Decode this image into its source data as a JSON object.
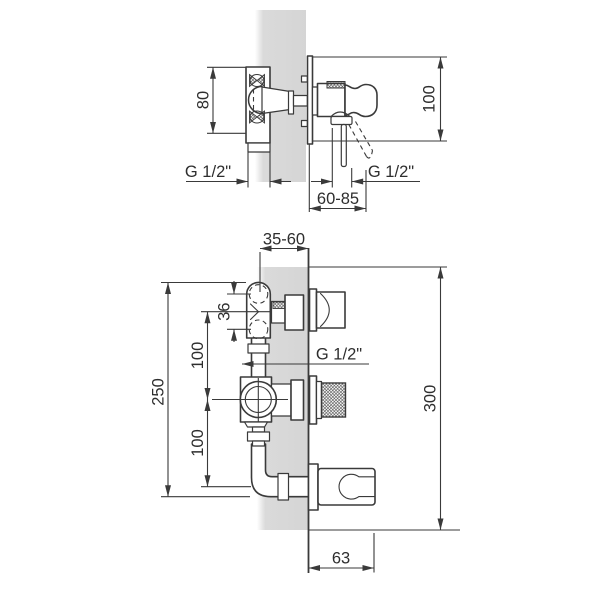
{
  "colors": {
    "background": "#ffffff",
    "line": "#3a3a3a",
    "wall_fill": "#d9d9d9",
    "text": "#2e2e2e"
  },
  "views": {
    "top": {
      "name": "side-section-view",
      "dims": {
        "d80": "80",
        "d100": "100",
        "g_left": "G 1/2\"",
        "g_right": "G 1/2\"",
        "d60_85": "60-85"
      }
    },
    "bottom": {
      "name": "assembly-view",
      "dims": {
        "d35_60": "35-60",
        "d36": "36",
        "d100_upper": "100",
        "d250": "250",
        "d100_lower": "100",
        "g_mid": "G 1/2\"",
        "d300": "300",
        "d63": "63"
      }
    }
  }
}
